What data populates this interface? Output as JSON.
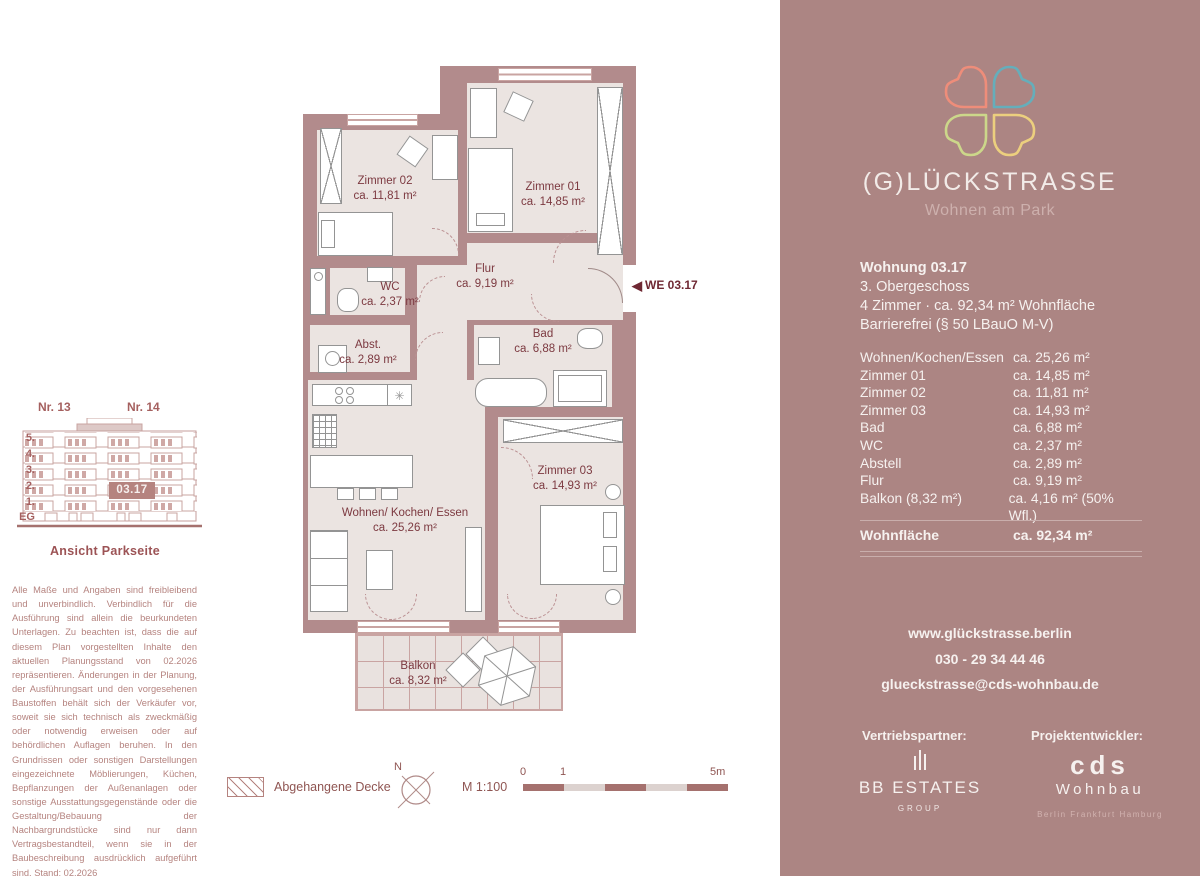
{
  "panel": {
    "brand": {
      "title": "(G)LÜCKSTRASSE",
      "subtitle": "Wohnen am Park"
    },
    "apartment": {
      "title": "Wohnung 03.17",
      "line1": "3. Obergeschoss",
      "line2": "4 Zimmer · ca. 92,34 m² Wohnfläche",
      "line3": "Barrierefrei (§ 50 LBauO M-V)"
    },
    "rooms": [
      {
        "label": "Wohnen/Kochen/Essen",
        "area": "ca. 25,26 m²"
      },
      {
        "label": "Zimmer 01",
        "area": "ca. 14,85 m²"
      },
      {
        "label": "Zimmer 02",
        "area": "ca. 11,81 m²"
      },
      {
        "label": "Zimmer 03",
        "area": "ca. 14,93 m²"
      },
      {
        "label": "Bad",
        "area": "ca. 6,88 m²"
      },
      {
        "label": "WC",
        "area": "ca. 2,37 m²"
      },
      {
        "label": "Abstell",
        "area": "ca. 2,89 m²"
      },
      {
        "label": "Flur",
        "area": "ca. 9,19 m²"
      },
      {
        "label": "Balkon (8,32 m²)",
        "area": "ca. 4,16 m² (50% Wfl.)"
      }
    ],
    "total": {
      "label": "Wohnfläche",
      "area": "ca. 92,34 m²"
    },
    "contact": {
      "website": "www.glückstrasse.berlin",
      "phone": "030 - 29 34 44 46",
      "email": "glueckstrasse@cds-wohnbau.de"
    },
    "partners": {
      "sales_label": "Vertriebspartner:",
      "dev_label": "Projektentwickler:",
      "sales_name": "BB ESTATES",
      "sales_sub": "GROUP",
      "dev_name": "cds",
      "dev_name2": "Wohnbau",
      "dev_cities": "Berlin  Frankfurt  Hamburg"
    }
  },
  "plan": {
    "unit_marker": "WE 03.17",
    "marker_triangle": "◀",
    "freezer_symbol": "✳",
    "rooms": {
      "zimmer02": {
        "name": "Zimmer 02",
        "area": "ca. 11,81 m²"
      },
      "zimmer01": {
        "name": "Zimmer 01",
        "area": "ca. 14,85 m²"
      },
      "wc": {
        "name": "WC",
        "area": "ca. 2,37 m²"
      },
      "abst": {
        "name": "Abst.",
        "area": "ca. 2,89 m²"
      },
      "flur": {
        "name": "Flur",
        "area": "ca. 9,19 m²"
      },
      "bad": {
        "name": "Bad",
        "area": "ca. 6,88 m²"
      },
      "wohnen": {
        "name": "Wohnen/ Kochen/ Essen",
        "area": "ca. 25,26 m²"
      },
      "zimmer03": {
        "name": "Zimmer 03",
        "area": "ca. 14,93 m²"
      },
      "balkon": {
        "name": "Balkon",
        "area": "ca. 8,32 m²"
      }
    }
  },
  "elevation": {
    "left_label": "Nr. 13",
    "right_label": "Nr. 14",
    "floors": [
      "5.",
      "4.",
      "3.",
      "2.",
      "1.",
      "EG"
    ],
    "unit": "03.17",
    "caption": "Ansicht Parkseite"
  },
  "disclaimer": "Alle Maße und Angaben sind freibleibend und unverbindlich. Verbindlich für die Ausführung sind allein die beurkundeten Unterlagen. Zu beachten ist, dass die auf diesem Plan vorgestellten Inhalte den aktuellen Planungsstand von 02.2026 repräsentieren. Änderungen in der Planung, der Ausführungsart und den vorgesehenen Baustoffen behält sich der Verkäufer vor, soweit sie sich technisch als zweckmäßig oder notwendig erweisen oder auf behördlichen Auflagen beruhen. In den Grundrissen oder sonstigen Darstellungen eingezeichnete Möblierungen, Küchen, Bepflanzungen der Außenanlagen oder sonstige Ausstattungsgegenstände oder die Gestaltung/Bebauung der Nachbargrundstücke sind nur dann Vertragsbestandteil, wenn sie in der Baubeschreibung ausdrücklich aufgeführt sind. Stand: 02.2026",
  "legend": {
    "hatch_label": "Abgehangene Decke",
    "north": "N",
    "scale_label": "M 1:100",
    "ticks": [
      "0",
      "1",
      "5m"
    ]
  },
  "colors": {
    "panel_bg": "#ac8583",
    "wall": "#b28b8c",
    "floor": "#ebe4e1",
    "plan_text": "#7c3940",
    "marker_text": "#6f2833",
    "mauve_text": "#b5837f",
    "legend_text": "#8f5552",
    "scale_dark": "#a5716e",
    "scale_light": "#dcd2cf",
    "heart_coral": "#ee8d7a",
    "heart_teal": "#65aebb",
    "heart_green": "#ccd78a",
    "heart_yellow": "#eccf7e"
  }
}
